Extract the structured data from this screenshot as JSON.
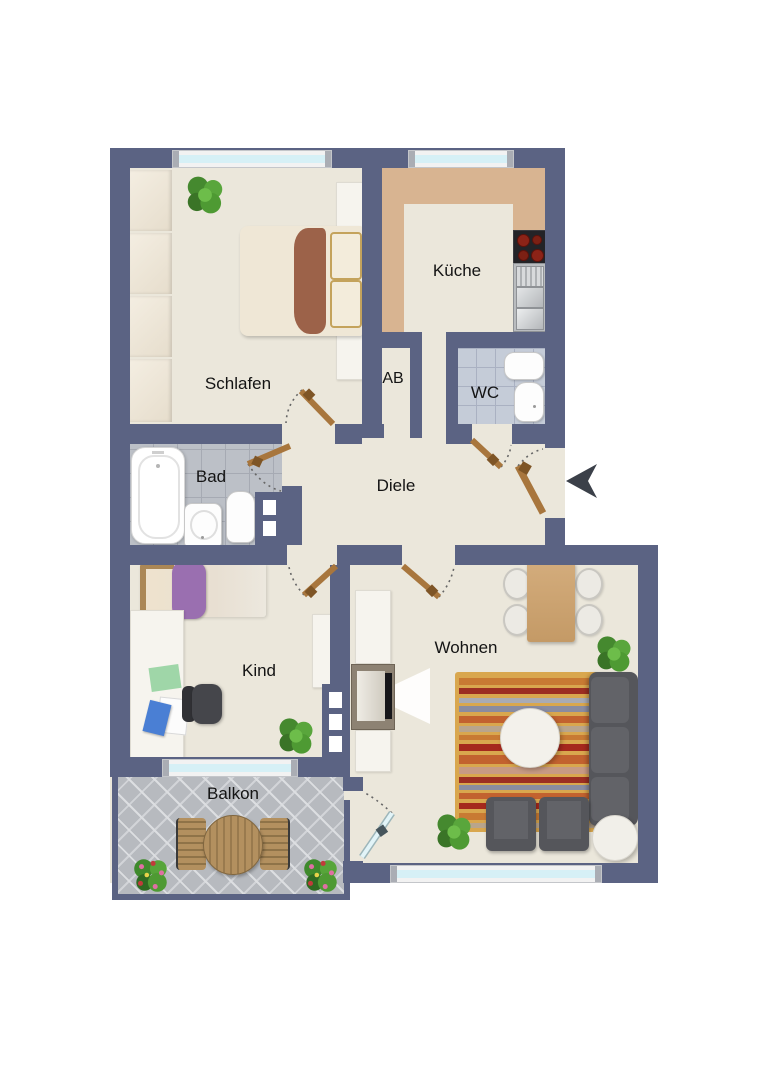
{
  "floorplan": {
    "type": "apartment-floor-plan",
    "rooms": [
      {
        "id": "schlafen",
        "label": "Schlafen",
        "furniture": [
          "wardrobe",
          "double-bed",
          "plant"
        ]
      },
      {
        "id": "kueche",
        "label": "Küche",
        "furniture": [
          "kitchen-counter",
          "stove",
          "kitchen-sink"
        ]
      },
      {
        "id": "ab",
        "label": "AB",
        "furniture": []
      },
      {
        "id": "wc",
        "label": "WC",
        "furniture": [
          "hand-basin",
          "toilet"
        ]
      },
      {
        "id": "bad",
        "label": "Bad",
        "furniture": [
          "bathtub",
          "hand-basin",
          "toilet"
        ]
      },
      {
        "id": "diele",
        "label": "Diele",
        "furniture": []
      },
      {
        "id": "kind",
        "label": "Kind",
        "furniture": [
          "single-bed",
          "desk",
          "office-chair",
          "shelf",
          "plant"
        ]
      },
      {
        "id": "wohnen",
        "label": "Wohnen",
        "furniture": [
          "dining-table",
          "dining-chairs",
          "tv-sideboard",
          "tv",
          "rug",
          "coffee-table",
          "sofa",
          "armchairs",
          "side-table",
          "plants"
        ]
      },
      {
        "id": "balkon",
        "label": "Balkon",
        "furniture": [
          "garden-table",
          "garden-chairs",
          "flower-pots"
        ]
      }
    ],
    "entrance": {
      "side": "right",
      "marker": "arrow-pointing-left"
    },
    "colors": {
      "wall": "#5b6383",
      "floor": "#ebe7db",
      "kitchen_counter": "#d8b491",
      "bathroom_tiles": "#bcc0c7",
      "wc_tiles": "#c5ccd8",
      "balcony_tiles": "#b7babf",
      "window_glass": "#d6f0f6",
      "door_leaf": "#a8763d",
      "sofa": "#55565b",
      "rug_base": "#d9a74e"
    }
  }
}
